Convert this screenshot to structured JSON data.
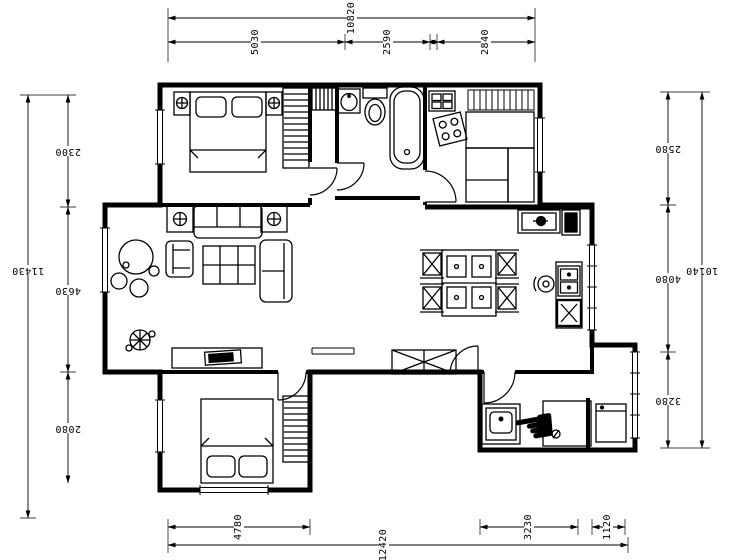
{
  "page": {
    "background": "#ffffff",
    "line_color": "#000000"
  },
  "dimensions": {
    "top": {
      "overall": "10820",
      "segments": [
        "5030",
        "2590",
        "2840"
      ]
    },
    "bottom": {
      "overall": "12420",
      "segments": [
        "4780",
        "3230",
        "1120"
      ]
    },
    "left": {
      "overall": "11430",
      "segments": [
        "2300",
        "4630",
        "2080"
      ]
    },
    "right": {
      "overall": "10140",
      "segments": [
        "2580",
        "4080",
        "3280"
      ]
    }
  },
  "cursor": {
    "glyph": "☚",
    "name": "hand-pointer"
  }
}
